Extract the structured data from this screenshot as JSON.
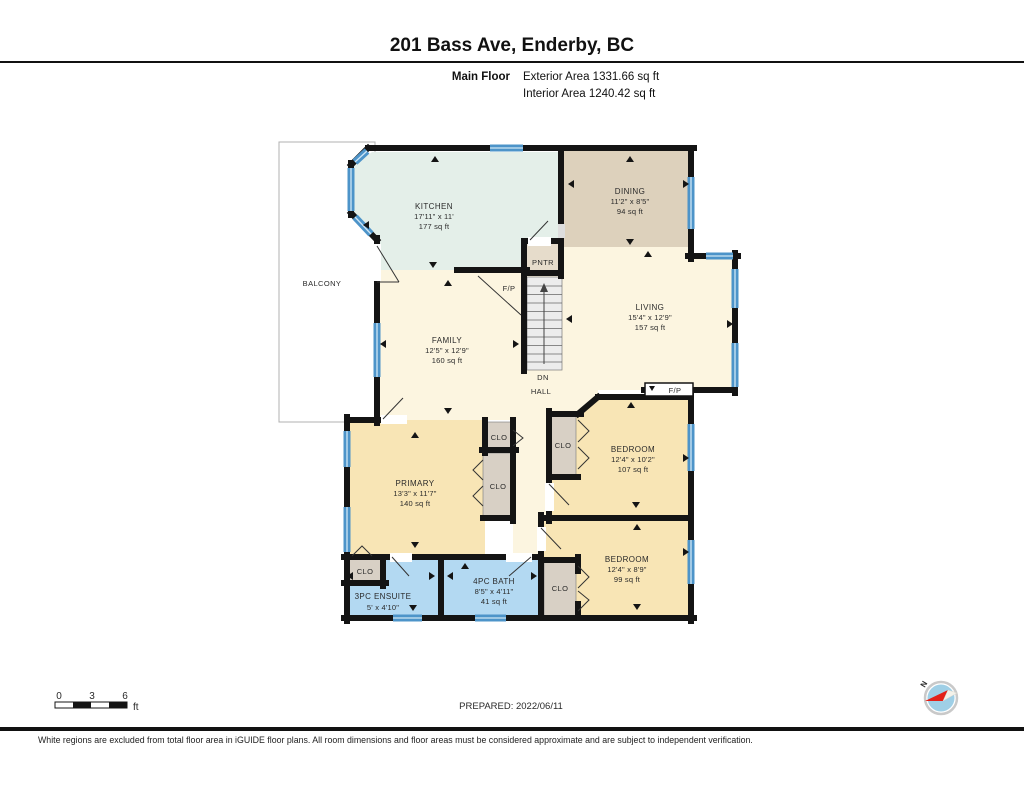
{
  "header": {
    "title": "201 Bass Ave, Enderby, BC",
    "floor_label": "Main Floor",
    "exterior_area": "Exterior Area 1331.66 sq ft",
    "interior_area": "Interior Area 1240.42 sq ft"
  },
  "rooms": {
    "kitchen": {
      "name": "KITCHEN",
      "dims": "17'11\" x 11'",
      "area": "177 sq ft"
    },
    "dining": {
      "name": "DINING",
      "dims": "11'2\" x 8'5\"",
      "area": "94 sq ft"
    },
    "living": {
      "name": "LIVING",
      "dims": "15'4\" x 12'9\"",
      "area": "157 sq ft"
    },
    "family": {
      "name": "FAMILY",
      "dims": "12'5\" x 12'9\"",
      "area": "160 sq ft"
    },
    "primary": {
      "name": "PRIMARY",
      "dims": "13'3\" x 11'7\"",
      "area": "140 sq ft"
    },
    "bedroom1": {
      "name": "BEDROOM",
      "dims": "12'4\" x 10'2\"",
      "area": "107 sq ft"
    },
    "bedroom2": {
      "name": "BEDROOM",
      "dims": "12'4\" x 8'9\"",
      "area": "99 sq ft"
    },
    "ensuite": {
      "name": "3PC ENSUITE",
      "dims": "5' x 4'10\""
    },
    "bath": {
      "name": "4PC BATH",
      "dims": "8'5\" x 4'11\"",
      "area": "41 sq ft"
    }
  },
  "labels": {
    "balcony": "BALCONY",
    "pantry": "PNTR",
    "hall": "HALL",
    "dn": "DN",
    "closet": "CLO",
    "fireplace": "F/P"
  },
  "scale_bar": {
    "t0": "0",
    "t3": "3",
    "t6": "6",
    "unit": "ft"
  },
  "prepared": "PREPARED: 2022/06/11",
  "compass_n": "N",
  "footer": "White regions are excluded from total floor area in iGUIDE floor plans. All room dimensions and floor areas must be considered approximate and are subject to independent verification.",
  "colors": {
    "wall": "#141414",
    "cream": "#fcf5e0",
    "mint": "#e4efe9",
    "tan": "#ddd1bc",
    "yellow": "#f8e5b5",
    "bath_blue": "#b3d9f2",
    "closet": "#d8d0c5",
    "pantry": "#e6dccb",
    "window": "#4d94c9",
    "stairs": "#ececec",
    "compass_red": "#e32119"
  }
}
